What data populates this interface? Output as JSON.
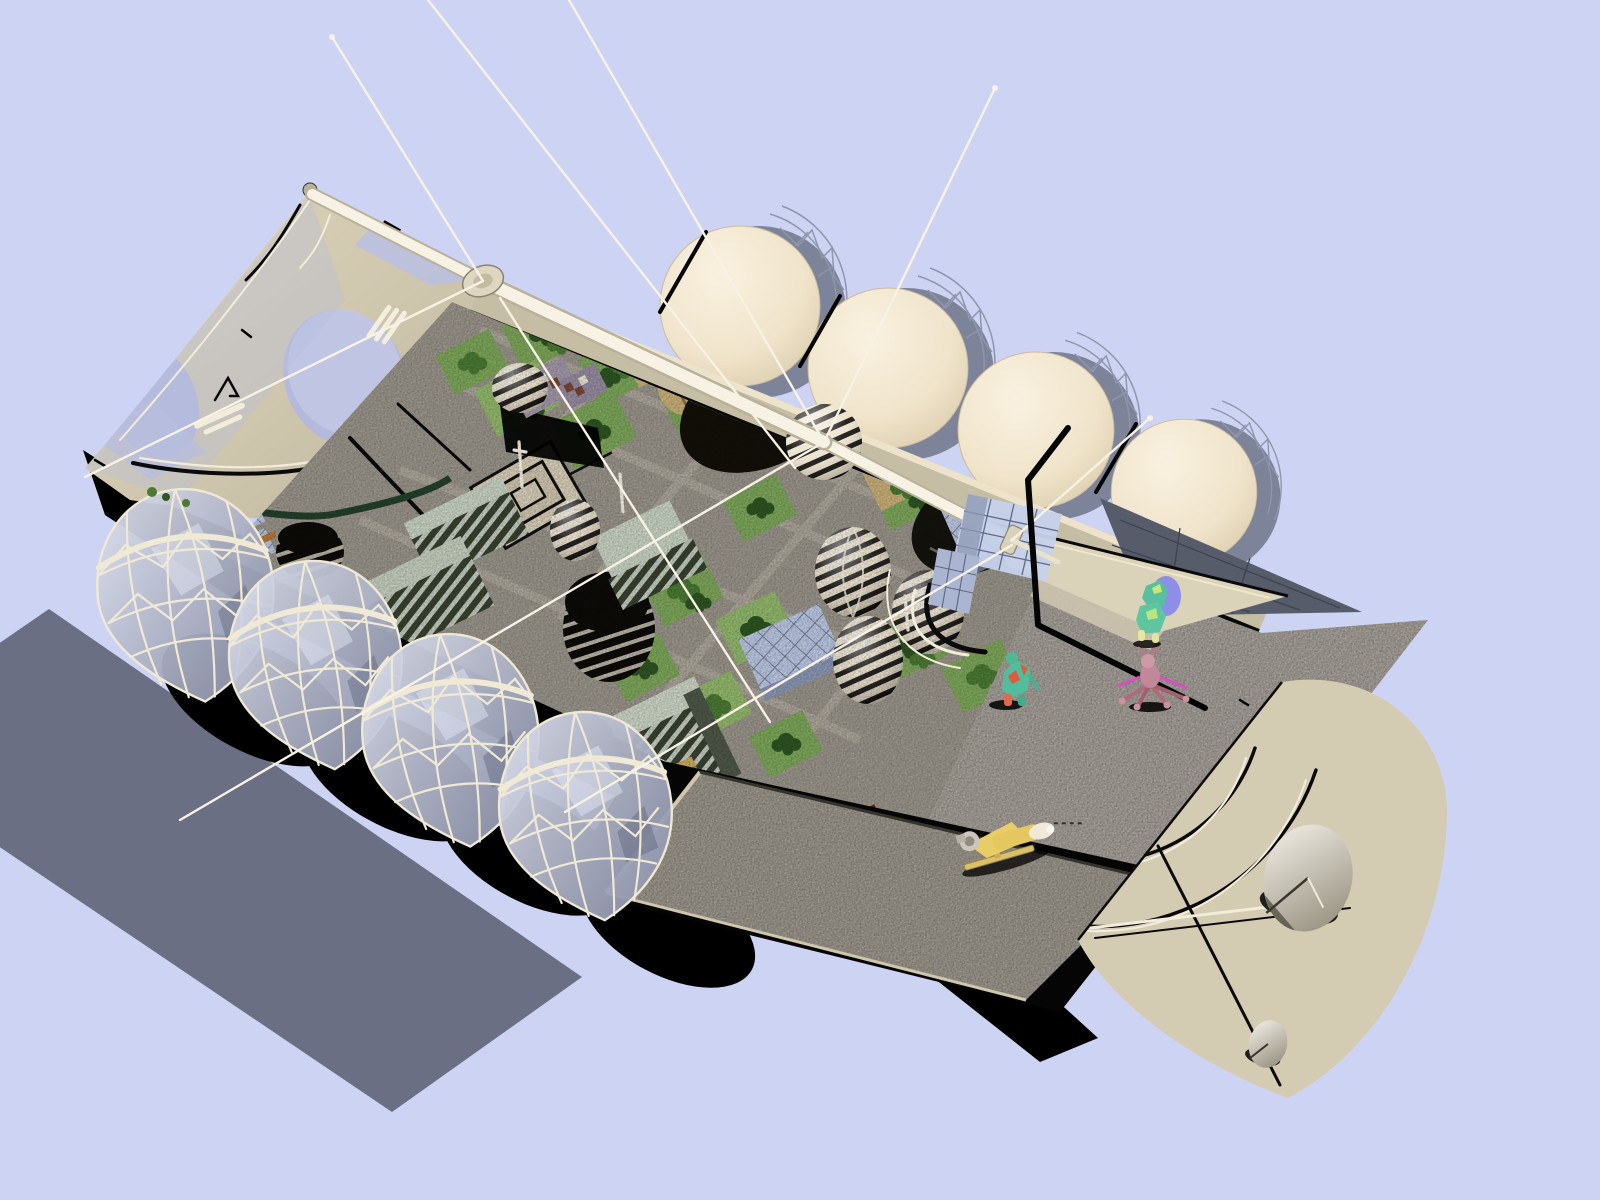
{
  "palette": {
    "sky": "#cdd4f3",
    "panel": "#6a6f84",
    "hull": "#cfc6ae",
    "hullLight": "#ded5bd",
    "hullDark": "#b3aa92",
    "balloon": "#f2e7d1",
    "meshGray": "#8f95ab",
    "window": "#b4badc",
    "windowHi": "#ccd2ec",
    "rim": "#c6bda5",
    "rimTop": "#ece3ca",
    "ink": "#060606",
    "deck": "#a8a29b",
    "deckLight": "#cdc4af",
    "bayFloor": "#9e988e",
    "sternHull": "#d4cbb3",
    "wedge": "#dbd2ba",
    "fin": "#575c6a",
    "finLine": "#3e4352",
    "strut": "#f0e9d6",
    "antenna": "#f7f2e4",
    "antennaDark": "#b9b19a",
    "grass": "#7da65a",
    "grassLight": "#92b86c",
    "treeDark": "#2e5522",
    "treeMid": "#4a7a33",
    "treeLight": "#639441",
    "sand": "#c9b078",
    "sandDark": "#8a6a42",
    "plazaBase": "#9a958b",
    "pathGray": "#ada79c",
    "plazaCream": "#d8cfb8",
    "mintTop": "#c9d4c4",
    "mintSide": "#39412f",
    "mintStripe": "#c2ccc0",
    "glass": "#bcc8e4",
    "glassLine": "#5f6878",
    "glassSide": "#8b97b5",
    "eggCream": "#ece2cc",
    "eggDark": "#0e0c08",
    "gold": "#a5873e",
    "goldLine": "#6b5526",
    "redBldg": "#5f2222",
    "roofLav": "#a198a8",
    "checker": "#7a4632",
    "checkerLight": "#e9e2d4",
    "orangeBeam": "#b5773a",
    "monorail": "#24402c",
    "dish": "#f6f3ec",
    "dishDark": "#97917f",
    "shuttleYellow": "#e5c75f",
    "shuttleNose": "#efe9da",
    "engine": "#c9c5bb",
    "teal": "#58c09e",
    "lime": "#c8e67a",
    "redPatch": "#e05a3e",
    "pinkBody": "#c79aa6",
    "magenta": "#d84fc0",
    "halo": "#7f82f0"
  },
  "scene": {
    "objects": [
      {
        "id": "sky"
      },
      {
        "id": "solar-shadow-panel"
      },
      {
        "id": "bow-hull"
      },
      {
        "id": "hull-windows"
      },
      {
        "id": "antenna-hub-fore"
      },
      {
        "id": "antenna-hub-mid"
      },
      {
        "id": "antenna-masts"
      },
      {
        "id": "guy-wires"
      },
      {
        "id": "garden-city-interior"
      },
      {
        "id": "tree-blocks"
      },
      {
        "id": "central-plaza"
      },
      {
        "id": "checkered-cottages"
      },
      {
        "id": "desert-tent"
      },
      {
        "id": "black-dome-building"
      },
      {
        "id": "ringed-dome-buildings"
      },
      {
        "id": "striped-egg-domes"
      },
      {
        "id": "mint-slab-buildings"
      },
      {
        "id": "glass-cube-buildings"
      },
      {
        "id": "gold-tower"
      },
      {
        "id": "red-brick-building"
      },
      {
        "id": "monorail"
      },
      {
        "id": "observation-domes"
      },
      {
        "id": "gas-balloon-domes"
      },
      {
        "id": "stern-deck"
      },
      {
        "id": "cargo-bay"
      },
      {
        "id": "shuttle-craft"
      },
      {
        "id": "stern-hull"
      },
      {
        "id": "comm-dishes"
      },
      {
        "id": "radiator-fin"
      },
      {
        "id": "solar-collector-panels"
      },
      {
        "id": "alien-figure-halo"
      },
      {
        "id": "alien-figure-teal"
      },
      {
        "id": "alien-figure-red-teal"
      },
      {
        "id": "alien-figure-spider"
      }
    ]
  }
}
